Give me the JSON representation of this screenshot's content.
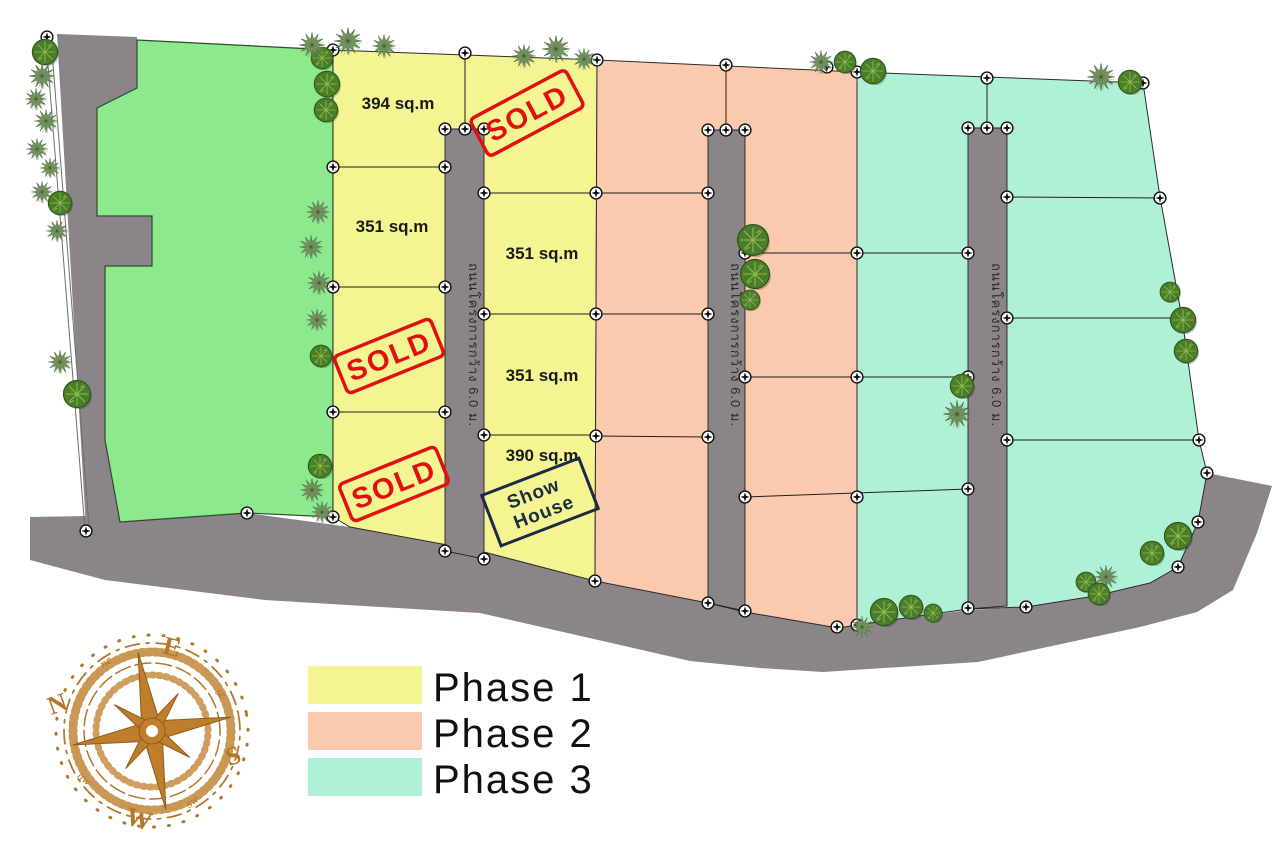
{
  "site_plan": {
    "plots": [
      "394 sq.m",
      "351 sq.m",
      "351 sq.m",
      "351 sq.m",
      "390 sq.m"
    ],
    "sold_stamps": [
      "SOLD",
      "SOLD",
      "SOLD"
    ],
    "show_house": {
      "line1": "Show",
      "line2": "House"
    },
    "roads": [
      {
        "label": "ถนนโครงการกว้าง 6.0 ม."
      },
      {
        "label": "ถนนโครงการกว้าง 6.0 ม."
      },
      {
        "label": "ถนนโครงการกว้าง 6.0 ม."
      }
    ]
  },
  "compass": {
    "north": "N",
    "east": "E",
    "south": "S",
    "west": "W",
    "northeast": "ne",
    "southeast": "se",
    "southwest": "sw",
    "northwest": "nw"
  },
  "legend": {
    "items": [
      {
        "label": "Phase 1",
        "color": "#F5F493"
      },
      {
        "label": "Phase 2",
        "color": "#FBC9AE"
      },
      {
        "label": "Phase 3",
        "color": "#AFF1D4"
      }
    ]
  },
  "colors": {
    "phase1": "#F5F493",
    "phase2": "#FBC9AE",
    "phase3": "#AFF1D4",
    "common_green": "#8DE98D",
    "road_gray": "#8B8589",
    "sold_red": "#E01111",
    "show_house_navy": "#1B2B45",
    "compass_brown": "#B5762A"
  }
}
